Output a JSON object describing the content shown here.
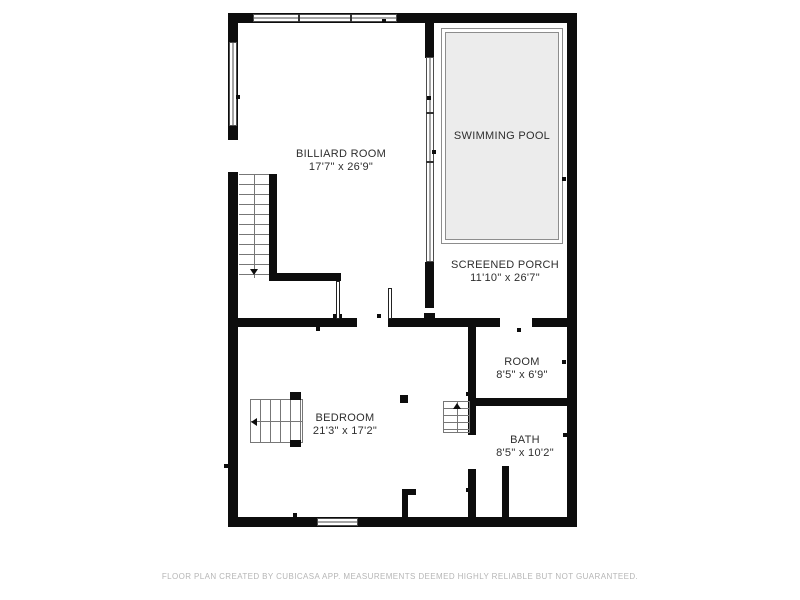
{
  "rooms": {
    "billiard": {
      "name": "BILLIARD ROOM",
      "dims": "17'7\" x 26'9\""
    },
    "pool": {
      "name": "SWIMMING POOL"
    },
    "porch": {
      "name": "SCREENED PORCH",
      "dims": "11'10\" x 26'7\""
    },
    "room": {
      "name": "ROOM",
      "dims": "8'5\" x 6'9\""
    },
    "bedroom": {
      "name": "BEDROOM",
      "dims": "21'3\" x 17'2\""
    },
    "bath": {
      "name": "BATH",
      "dims": "8'5\" x 10'2\""
    }
  },
  "stairs": {
    "main_direction": "down",
    "bedroom_direction": "left",
    "small_direction": "up"
  },
  "footer": {
    "disclaimer": "FLOOR PLAN CREATED BY CUBICASA APP. MEASUREMENTS DEEMED HIGHLY RELIABLE BUT NOT GUARANTEED."
  },
  "colors": {
    "wall": "#0d0d0d",
    "pool_fill": "#ececec",
    "pool_border": "#8d8d8d",
    "label_text": "#2e2e2e",
    "footer_text": "#b6b6b6"
  }
}
